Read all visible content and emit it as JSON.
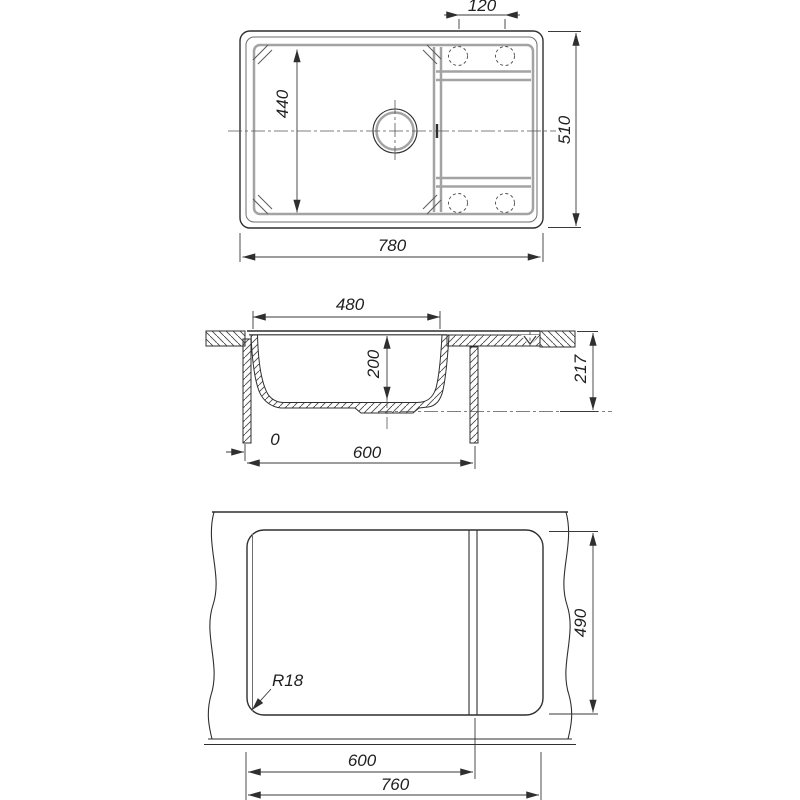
{
  "drawing": {
    "subject": "kitchen-sink-dimension-drawing",
    "background": "#ffffff",
    "line_color": "#2f2f2f",
    "top_view": {
      "dims": {
        "tap_hole_spacing": "120",
        "bowl_length": "440",
        "overall_length": "780",
        "overall_width": "510"
      }
    },
    "section_view": {
      "dims": {
        "bowl_top_width": "480",
        "bowl_depth": "200",
        "under_counter_height": "217",
        "zero_offset": "0",
        "cabinet_width": "600"
      }
    },
    "bottom_view": {
      "dims": {
        "cutout_depth": "490",
        "corner_radius": "R18",
        "fold_width": "600",
        "footprint_width": "760"
      }
    }
  }
}
